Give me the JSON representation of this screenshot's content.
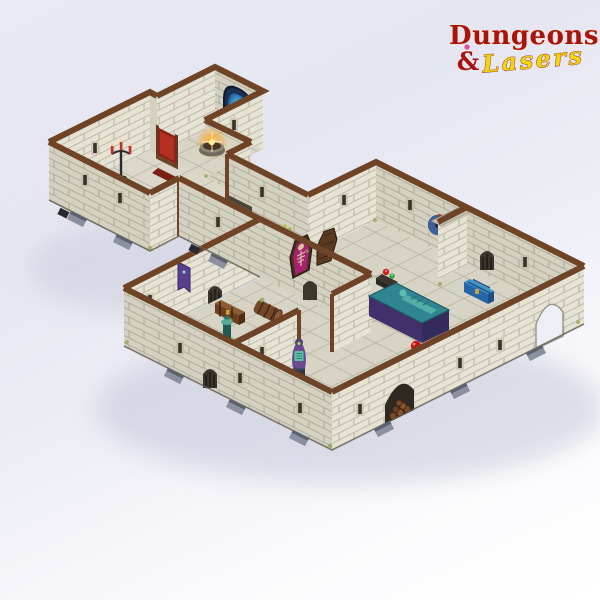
{
  "logo": {
    "word_top": "Dungeons",
    "ampersand": "&",
    "word_bottom": "Lasers",
    "word_top_color": "#a8130e",
    "word_bottom_color": "#f2d50e",
    "gem_color": "#e14a9e"
  },
  "scene": {
    "type": "product-photo",
    "subject": "modular stone dungeon terrain set, isometric top-down view",
    "background": {
      "top": "#e7e7f2",
      "bottom": "#ffffff"
    },
    "palette": {
      "wall_light": "#e6e2d4",
      "wall_shade": "#d5d1c1",
      "mortar": "#8e8a79",
      "trim_brown": "#6f4426",
      "floor": "#d8d5c7",
      "shadow": "#c5c8da",
      "foot_grey": "#8a90a0"
    },
    "props": [
      {
        "name": "arcane-portal",
        "color": "#2a6fb0"
      },
      {
        "name": "fire-brazier",
        "color": "#f7a62e"
      },
      {
        "name": "throne",
        "color": "#b43020"
      },
      {
        "name": "candelabra",
        "color": "#c03028"
      },
      {
        "name": "mushroom-critter",
        "color": "#7a3f9a"
      },
      {
        "name": "blood-fireplace",
        "color": "#e03020"
      },
      {
        "name": "open-coffin-skeleton",
        "color": "#a82070"
      },
      {
        "name": "coffin-lid",
        "color": "#5a3a22"
      },
      {
        "name": "treasure-table-gems",
        "color": "#cc2222"
      },
      {
        "name": "blue-chest",
        "color": "#2b6fb5"
      },
      {
        "name": "stone-pillar",
        "color": "#c9c4b2"
      },
      {
        "name": "wall-shield",
        "color": "#3f5f9a"
      },
      {
        "name": "sarcophagus",
        "color": "#2f8591"
      },
      {
        "name": "barrel-upright",
        "color": "#6e4527"
      },
      {
        "name": "potion-bench",
        "color": "#e060a8"
      },
      {
        "name": "red-beetle",
        "color": "#bf1b14"
      },
      {
        "name": "wooden-chest",
        "color": "#7a4a26"
      },
      {
        "name": "barrel-lying",
        "color": "#74492a"
      },
      {
        "name": "spiral-staircase",
        "color": "#2a7f74"
      },
      {
        "name": "robed-statue",
        "color": "#6b4b8f"
      },
      {
        "name": "wall-banner",
        "color": "#5a3f8f"
      },
      {
        "name": "firewood-pile",
        "color": "#7a4a26"
      }
    ]
  }
}
